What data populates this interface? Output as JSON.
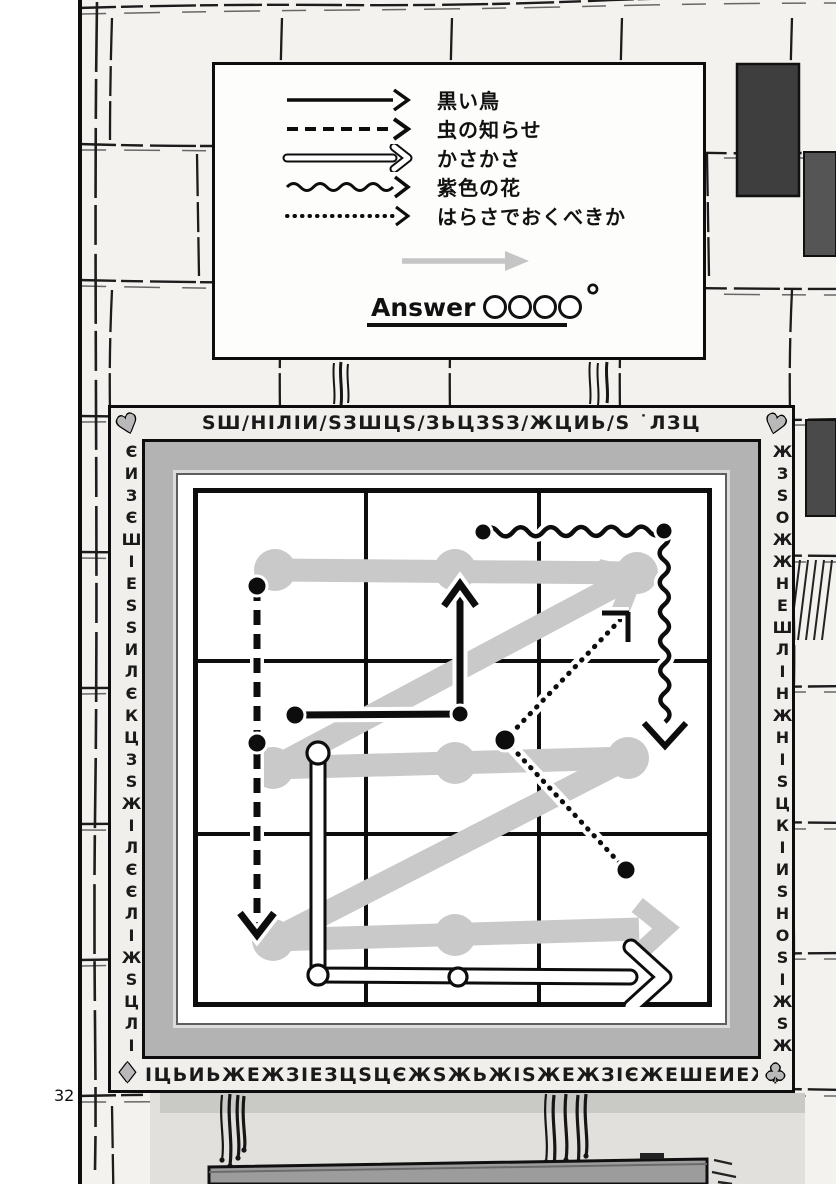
{
  "page": {
    "number": "32"
  },
  "colors": {
    "ink": "#0d0d0d",
    "wall": "#f3f2ef",
    "gray_path": "#c9c9c9",
    "frame_mat": "#b3b3b3",
    "shelf": "#9c9c9c",
    "legend_gray_arrow": "#c5c5c5"
  },
  "legend": {
    "rows": [
      {
        "style": "solid",
        "label": "黒い鳥"
      },
      {
        "style": "dashed",
        "label": "虫の知らせ"
      },
      {
        "style": "double",
        "label": "かさかさ"
      },
      {
        "style": "wavy",
        "label": "紫色の花"
      },
      {
        "style": "dotted",
        "label": "はらさでおくべきか"
      }
    ],
    "answer_word": "Answer",
    "answer_circle_count": 4,
    "degree_mark": "°"
  },
  "frame": {
    "text_top": "ЅШ/НІЛІИ/ЅЗШЦЅ/ЗЬЦЗЅЗ/ЖЦИЬ/Ѕ ˙ЛЗЦ",
    "text_bottom": "ІЦЬИЬЖЕЖЗІЕЗЦЅЦЄЖЅЖЬЖІЅЖЕЖЗІЄЖЕШЕИЕЖЕЖ",
    "text_left": "ЄИЗЄШІЕЅЅИЛЄКЦЗЅЖІЛЄЄЛІЖЅЦЛІЅІЖЄИУ",
    "text_right": "ЖЗЅОЖЖНЕШЛІНЖНІЅЦКІИЅНОЅІЖЅЖІЛЕЖЗЖ",
    "suits": {
      "top_left": "♥",
      "top_right": "♥",
      "bottom_left": "♦",
      "bottom_right": "♣"
    }
  },
  "puzzle": {
    "grid": {
      "cols": 3,
      "rows": 3,
      "size": 519
    },
    "gray_path": {
      "band": 23,
      "node_r": 21,
      "segments": [
        [
          [
            82,
            82
          ],
          [
            444,
            85
          ]
        ],
        [
          [
            80,
            280
          ],
          [
            437,
            90
          ]
        ],
        [
          [
            80,
            280
          ],
          [
            435,
            270
          ]
        ],
        [
          [
            80,
            452
          ],
          [
            435,
            270
          ]
        ],
        [
          [
            80,
            452
          ],
          [
            446,
            441
          ]
        ]
      ],
      "nodes": [
        [
          82,
          82
        ],
        [
          262,
          82
        ],
        [
          444,
          85
        ],
        [
          80,
          280
        ],
        [
          262,
          275
        ],
        [
          435,
          270
        ],
        [
          80,
          452
        ],
        [
          262,
          447
        ]
      ],
      "heads": [
        {
          "tip": [
            441,
            88
          ],
          "angle": -28
        },
        {
          "tip": [
            473,
            440
          ],
          "angle": -2
        }
      ]
    },
    "arrows": [
      {
        "id": "dashed-arrow",
        "style": "dashed",
        "pts": [
          [
            64,
            98
          ],
          [
            64,
            438
          ]
        ],
        "dots": [
          [
            64,
            98,
            10
          ],
          [
            64,
            255,
            10
          ]
        ],
        "head": {
          "type": "v",
          "tip": [
            64,
            447
          ],
          "angle": 90
        }
      },
      {
        "id": "solid-arrow",
        "style": "solid",
        "pts": [
          [
            102,
            227
          ],
          [
            267,
            226
          ],
          [
            267,
            102
          ]
        ],
        "dots": [
          [
            102,
            227,
            10
          ],
          [
            267,
            226,
            9
          ]
        ],
        "head": {
          "type": "v",
          "tip": [
            267,
            96
          ],
          "angle": -90
        }
      },
      {
        "id": "wavy-arrow",
        "style": "wavy",
        "pts": [
          [
            290,
            44
          ],
          [
            471,
            43
          ],
          [
            472,
            234
          ]
        ],
        "dots": [
          [
            290,
            44,
            9
          ],
          [
            471,
            43,
            9
          ]
        ],
        "head": {
          "type": "v",
          "tip": [
            472,
            258
          ],
          "angle": 90
        }
      },
      {
        "id": "dotted-arrow",
        "style": "dotted",
        "pts": [
          [
            433,
            382
          ],
          [
            312,
            252
          ],
          [
            428,
            131
          ]
        ],
        "dots": [
          [
            312,
            252,
            11
          ],
          [
            433,
            382,
            10
          ]
        ],
        "head": {
          "type": "corner",
          "tip": [
            435,
            125
          ]
        }
      },
      {
        "id": "double-arrow",
        "style": "double",
        "pts": [
          [
            125,
            265
          ],
          [
            125,
            487
          ],
          [
            437,
            489
          ]
        ],
        "open_dots": [
          [
            125,
            265,
            11
          ],
          [
            125,
            487,
            10
          ],
          [
            265,
            489,
            9
          ]
        ],
        "head": {
          "type": "open",
          "tip": [
            471,
            489
          ],
          "angle": 0
        }
      }
    ]
  }
}
